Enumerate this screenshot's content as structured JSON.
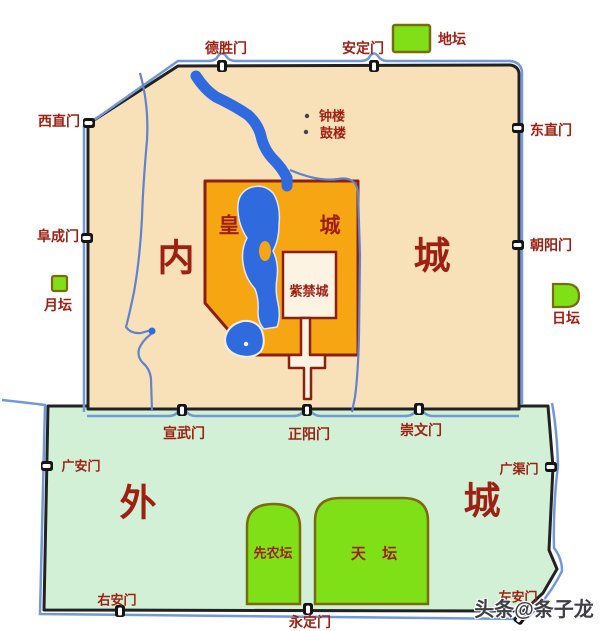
{
  "regions": {
    "inner_city_left": "内",
    "inner_city_right": "城",
    "imperial_city_left": "皇",
    "imperial_city_right": "城",
    "forbidden_city": "紫禁城",
    "outer_city_left": "外",
    "outer_city_right": "城"
  },
  "gates": {
    "deshengmen": "德胜门",
    "andingmen": "安定门",
    "xizhimen": "西直门",
    "fuchengmen": "阜成门",
    "dongzhimen": "东直门",
    "chaoyangmen": "朝阳门",
    "xuanwumen": "宣武门",
    "zhengyangmen": "正阳门",
    "chongwenmen": "崇文门",
    "guanganmen": "广安门",
    "guangqumen": "广渠门",
    "youanmen": "右安门",
    "yongdingmen": "永定门",
    "zuoanmen": "左安门"
  },
  "altars": {
    "ditan": "地坛",
    "yuetan": "月坛",
    "ritan": "日坛",
    "xiannongtan": "先农坛",
    "tiantan": "天 坛"
  },
  "towers": {
    "zhonglou": "钟楼",
    "gulou": "鼓楼"
  },
  "watermark": "头条@条子龙",
  "colors": {
    "inner_city_fill": "#f8e1b8",
    "imperial_city_fill": "#f7a613",
    "forbidden_city_fill": "#fdf3e3",
    "outer_city_fill": "#d2f0d6",
    "altar_green": "#80e018",
    "altar_border": "#7a6a10",
    "water_blue": "#2f6bdf",
    "moat_blue": "#7298d8",
    "wall_black": "#222222",
    "label_red": "#9e2012",
    "border_dark_red": "#8b2012"
  }
}
